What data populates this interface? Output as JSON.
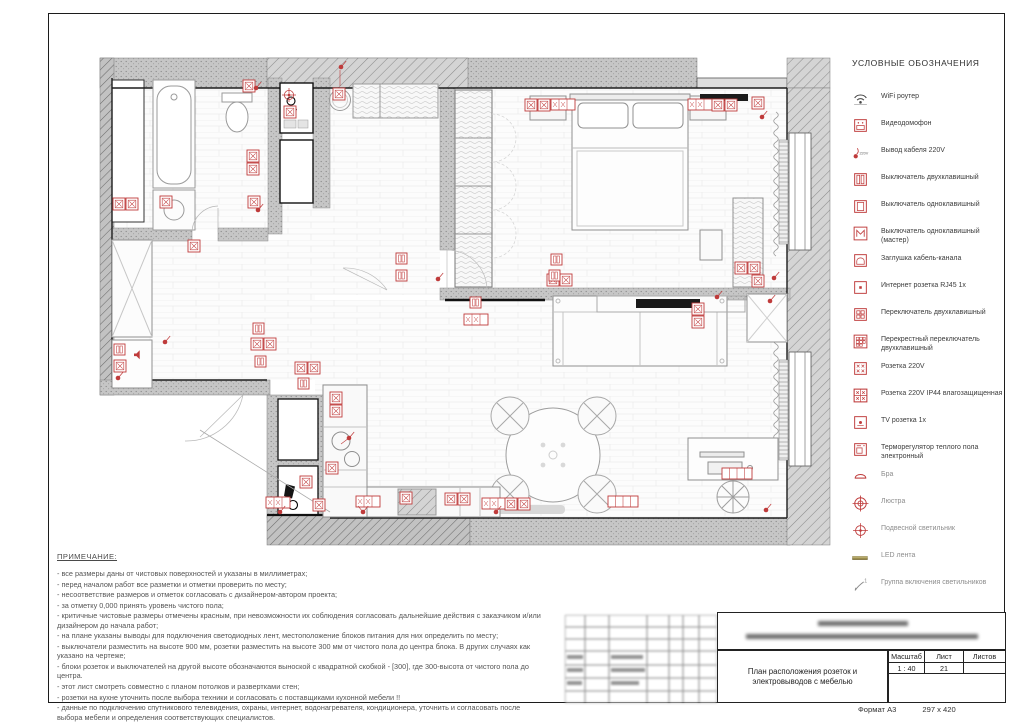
{
  "legend": {
    "title": "УСЛОВНЫЕ ОБОЗНАЧЕНИЯ",
    "items": [
      {
        "icon": "wifi-router-icon",
        "label": "WiFi роутер",
        "group": "electrical"
      },
      {
        "icon": "video-intercom-icon",
        "label": "Видеодомофон",
        "group": "electrical"
      },
      {
        "icon": "cable-outlet-220v-icon",
        "label": "Вывод кабеля 220V",
        "group": "electrical"
      },
      {
        "icon": "switch-two-key-icon",
        "label": "Выключатель двухклавишный",
        "group": "electrical"
      },
      {
        "icon": "switch-one-key-icon",
        "label": "Выключатель одноклавишный",
        "group": "electrical"
      },
      {
        "icon": "switch-one-key-master-icon",
        "label": "Выключатель одноклавишный (мастер)",
        "group": "electrical"
      },
      {
        "icon": "cable-channel-plug-icon",
        "label": "Заглушка кабель-канала",
        "group": "electrical"
      },
      {
        "icon": "internet-socket-icon",
        "label": "Интернет розетка RJ45 1x",
        "group": "electrical"
      },
      {
        "icon": "toggle-two-key-icon",
        "label": "Переключатель двухклавишный",
        "group": "electrical"
      },
      {
        "icon": "cross-toggle-icon",
        "label": "Перекрестный переключатель двухклавишный",
        "group": "electrical"
      },
      {
        "icon": "socket-220v-icon",
        "label": "Розетка 220V",
        "group": "electrical"
      },
      {
        "icon": "socket-220v-ip44-icon",
        "label": "Розетка 220V IP44 влагозащищенная",
        "group": "electrical"
      },
      {
        "icon": "tv-socket-icon",
        "label": "TV розетка 1x",
        "group": "electrical"
      },
      {
        "icon": "thermostat-icon",
        "label": "Терморегулятор теплого пола электронный",
        "group": "electrical"
      },
      {
        "icon": "sconce-icon",
        "label": "Бра",
        "group": "lighting"
      },
      {
        "icon": "chandelier-icon",
        "label": "Люстра",
        "group": "lighting"
      },
      {
        "icon": "pendant-light-icon",
        "label": "Подвесной светильник",
        "group": "lighting"
      },
      {
        "icon": "led-strip-icon",
        "label": "LED лента",
        "group": "lighting"
      },
      {
        "icon": "light-group-icon",
        "label": "Группа включения светильников",
        "group": "lighting"
      }
    ]
  },
  "notes": {
    "title": "ПРИМЕЧАНИЕ:",
    "lines": [
      "- все размеры даны от чистовых поверхностей и указаны в миллиметрах;",
      "- перед началом работ все разметки и отметки проверить по месту;",
      "- несоответствие размеров и отметок согласовать с дизайнером-автором проекта;",
      "- за отметку 0,000 принять уровень чистого пола;",
      "- критичные чистовые размеры отмечены красным, при невозможности их соблюдения согласовать дальнейшие действия с заказчиком и/или дизайнером до начала работ;",
      "- на плане указаны выводы для подключения светодиодных лент, местоположение блоков питания для них определить по месту;",
      "- выключатели разместить на высоте 900 мм, розетки разместить на высоте 300 мм от чистого пола до центра блока. В других случаях как указано на чертеже;",
      "- блоки розеток и выключателей на другой высоте обозначаются выноской с квадратной скобкой - [300], где 300-высота от чистого пола до центра.",
      "- этот лист смотреть совместно с планом потолков и развертками стен;",
      "- розетки на кухне уточнить после выбора техники и согласовать с поставщиками кухонной мебели !!",
      "- данные по подключению спутникового телевидения, охраны, интернет, водонагревателя, кондиционера, уточнить и согласовать после выбора мебели и определения соответствующих специалистов."
    ]
  },
  "title_block": {
    "drawing_title": "План расположения розеток и электровыводов с мебелью",
    "scale_label": "Масштаб",
    "scale_value": "1 : 40",
    "sheet_label": "Лист",
    "sheet_value": "21",
    "sheets_label": "Листов",
    "sheets_value": "",
    "format_label": "Формат А3",
    "format_size": "297 x 420"
  },
  "colors": {
    "symbol_red": "#bf3b3b",
    "wall_gray": "#c6c6c6",
    "led_strip": "#9b8d4d"
  }
}
